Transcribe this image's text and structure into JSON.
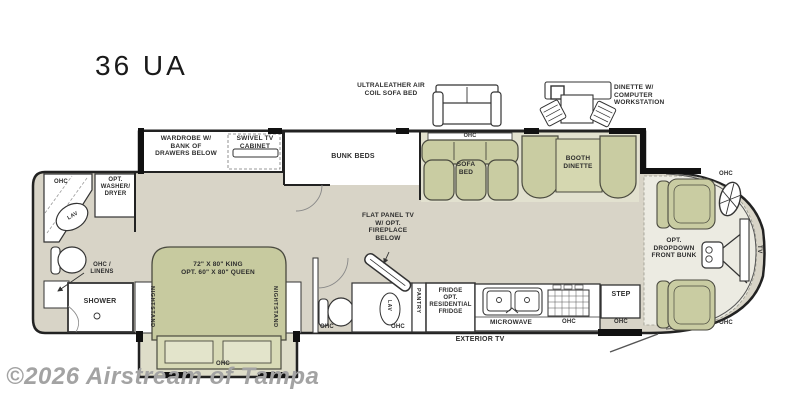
{
  "title": "36 UA",
  "watermark": "©2026 Airstream of Tampa",
  "colors": {
    "floor": "#d8d4c7",
    "slide_floor": "#e2e1cf",
    "bed_slide_floor": "#deddc9",
    "cab_floor": "#ecebe2",
    "furniture_olive": "#c9cca2",
    "bed_olive": "#c7ca9f",
    "table_olive": "#d5d7b0",
    "wall": "#222222",
    "label_text": "#2d2d2d",
    "watermark_gray": "#a3a3a3"
  },
  "callouts": {
    "sofa": "ULTRALEATHER AIR\nCOIL SOFA BED",
    "dinette": "DINETTE W/\nCOMPUTER\nWORKSTATION"
  },
  "labels": {
    "wardrobe": "WARDROBE W/\nBANK OF\nDRAWERS BELOW",
    "swivel_tv": "SWIVEL TV\nCABINET",
    "bunk_beds": "BUNK BEDS",
    "ohc_sofa": "OHC",
    "sofa_bed": "SOFA\nBED",
    "booth_dinette": "BOOTH\nDINETTE",
    "ohc_bath": "OHC",
    "washer": "OPT.\nWASHER/\nDRYER",
    "lav_rear": "LAV",
    "ohc_linens": "OHC /\nLINENS",
    "shower": "SHOWER",
    "bed": "72\" X 80\" KING\nOPT. 60\" X 80\" QUEEN",
    "nightstand_left": "NIGHTSTAND",
    "nightstand_right": "NIGHTSTAND",
    "ohc_bed": "OHC",
    "tv_fireplace": "FLAT PANEL TV\nW/ OPT.\nFIREPLACE\nBELOW",
    "ohc_toilet": "OHC",
    "lav_mid": "LAV",
    "ohc_lav": "OHC",
    "pantry": "PANTRY",
    "fridge": "FRIDGE\nOPT.\nRESIDENTIAL\nFRIDGE",
    "microwave": "MICROWAVE",
    "ohc_kitchen": "OHC",
    "step": "STEP",
    "ohc_step": "OHC",
    "exterior_tv": "EXTERIOR TV",
    "front_bunk": "OPT.\nDROPDOWN\nFRONT BUNK",
    "ohc_cab_top": "OHC",
    "ohc_cab_bottom": "OHC",
    "tv_front": "TV"
  }
}
